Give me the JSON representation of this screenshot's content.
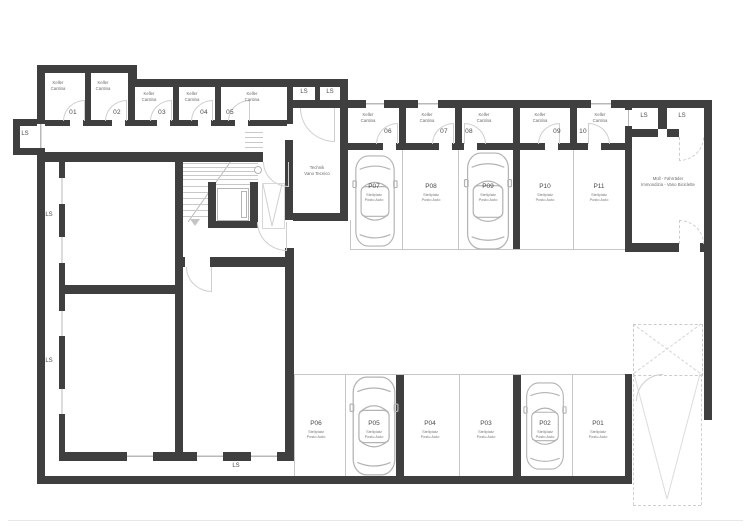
{
  "title": "Basement parking floor plan",
  "labels": {
    "ls": "LS",
    "keller_de": "Keller",
    "keller_it": "Cantina",
    "stellplatz_de": "Stellplatz",
    "stellplatz_it": "Posto Auto"
  },
  "cellars": [
    {
      "num": "01"
    },
    {
      "num": "02"
    },
    {
      "num": "03"
    },
    {
      "num": "04"
    },
    {
      "num": "05"
    },
    {
      "num": "06"
    },
    {
      "num": "07"
    },
    {
      "num": "08"
    },
    {
      "num": "09"
    },
    {
      "num": "10"
    }
  ],
  "parking": [
    {
      "id": "P01"
    },
    {
      "id": "P02"
    },
    {
      "id": "P03"
    },
    {
      "id": "P04"
    },
    {
      "id": "P05"
    },
    {
      "id": "P06"
    },
    {
      "id": "P07"
    },
    {
      "id": "P08"
    },
    {
      "id": "P09"
    },
    {
      "id": "P10"
    },
    {
      "id": "P11"
    }
  ],
  "rooms": {
    "technik_de": "Technik",
    "technik_it": "Vano Tecnico",
    "muell_de": "Müll - Fahrräder",
    "muell_it": "Immondizia - Vano Biciclette"
  },
  "colors": {
    "wall": "#3f3f3f",
    "thin_line": "#c6c6c6",
    "door_arc": "#cfcfcf"
  }
}
